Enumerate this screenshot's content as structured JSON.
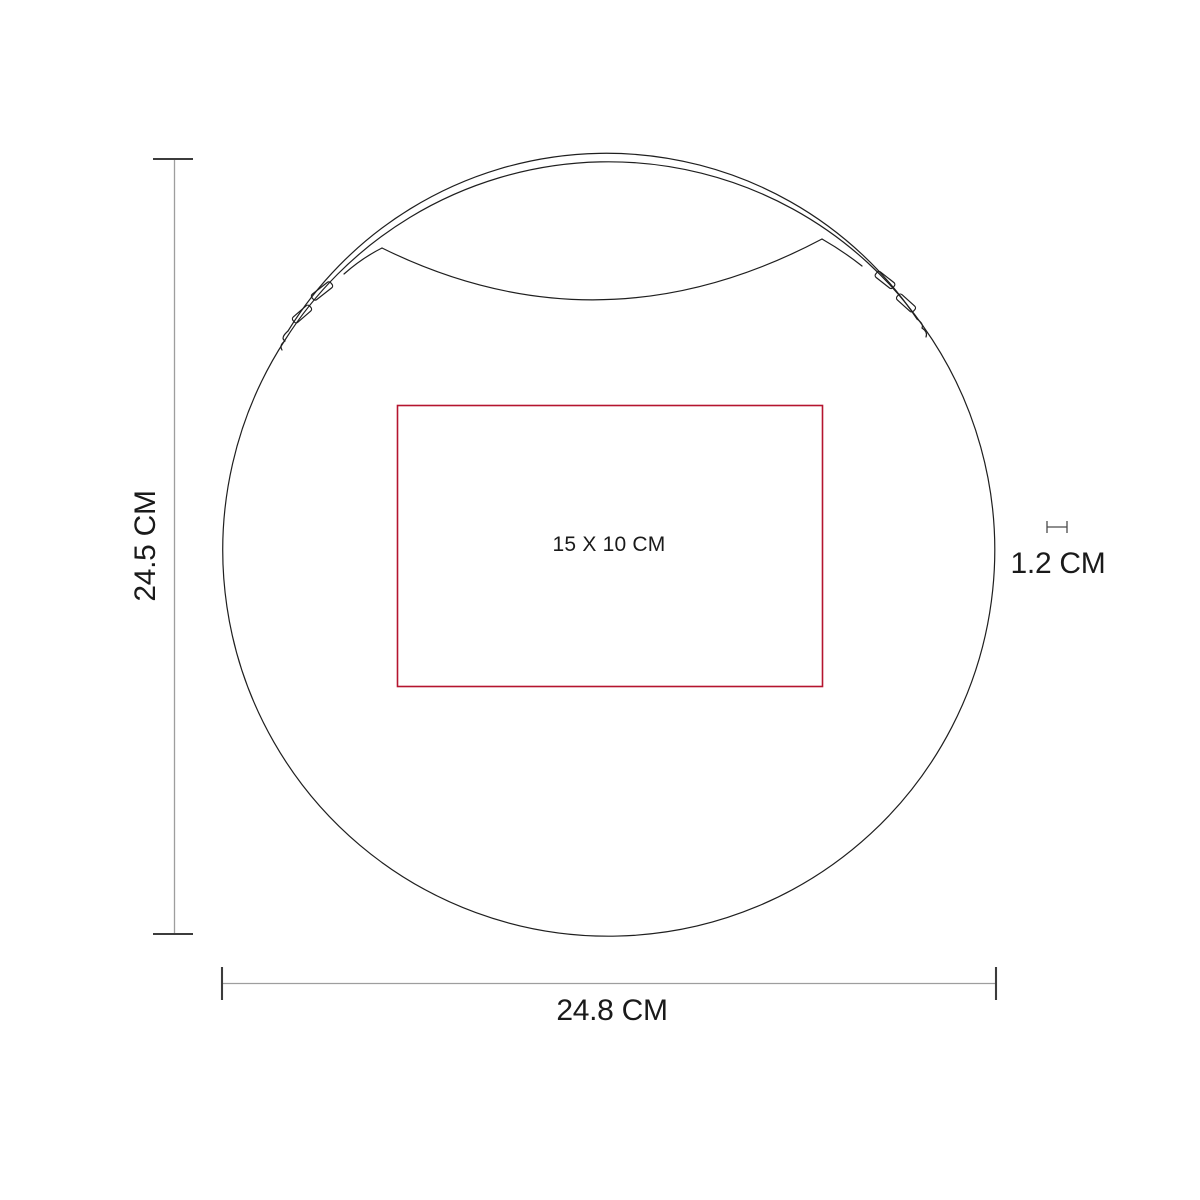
{
  "diagram": {
    "labels": {
      "height": "24.5 CM",
      "width": "24.8 CM",
      "thickness": "1.2 CM",
      "print_area": "15 X 10 CM"
    },
    "colors": {
      "outline": "#1f1f1f",
      "print_area": "#b5152f",
      "dimension_line": "#9e9e9e",
      "dimension_tick": "#3c3c3c",
      "mini_dimension": "#4a4a4a",
      "text": "#1a1a1a"
    }
  }
}
